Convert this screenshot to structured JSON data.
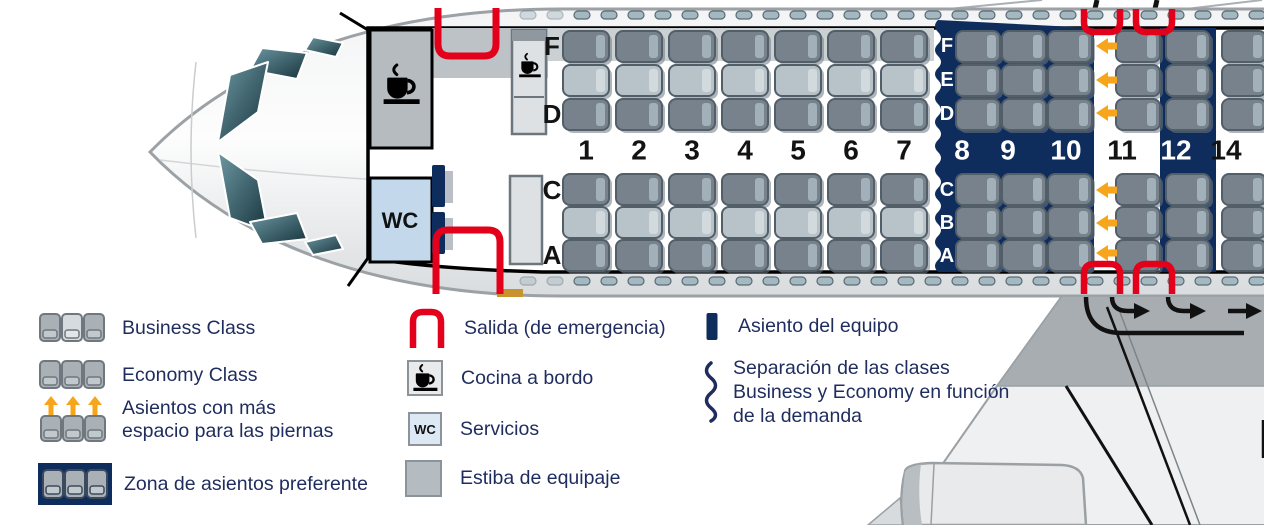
{
  "colors": {
    "navy": "#0e2c5c",
    "text_navy": "#1f2c5e",
    "red": "#e2001a",
    "orange": "#f7a51b",
    "door_sill": "#c8922f",
    "wc_blue": "#c3d9eb",
    "seat_dark": "#77828c",
    "seat_dark_border": "#525f69",
    "seat_light": "#b8c2c9",
    "seat_tab": "#a2b0b9",
    "seat_tab_light": "#d2dade",
    "seat_shadow": "#6e7a84",
    "galley_gray": "#b5bbbf",
    "band_gray": "#cbd0d3",
    "window_tick": "#a4b8c2"
  },
  "plan": {
    "wc_label": "WC",
    "front_letters_top": [
      "F",
      "D"
    ],
    "front_letters_bottom": [
      "C",
      "A"
    ],
    "zone_letters_top": [
      "F",
      "E",
      "D"
    ],
    "zone_letters_bottom": [
      "C",
      "B",
      "A"
    ],
    "rows": [
      {
        "number": "1",
        "seat_style": "business",
        "band": "white"
      },
      {
        "number": "2",
        "seat_style": "business",
        "band": "white"
      },
      {
        "number": "3",
        "seat_style": "business",
        "band": "white"
      },
      {
        "number": "4",
        "seat_style": "business",
        "band": "white"
      },
      {
        "number": "5",
        "seat_style": "business",
        "band": "white"
      },
      {
        "number": "6",
        "seat_style": "business",
        "band": "white"
      },
      {
        "number": "7",
        "seat_style": "business",
        "band": "white"
      },
      {
        "number": "8",
        "seat_style": "economy",
        "band": "navy"
      },
      {
        "number": "9",
        "seat_style": "economy",
        "band": "navy"
      },
      {
        "number": "10",
        "seat_style": "economy",
        "band": "navy"
      },
      {
        "number": "11",
        "seat_style": "economy",
        "band": "white",
        "extra_legroom": true
      },
      {
        "number": "12",
        "seat_style": "economy",
        "band": "navy"
      },
      {
        "number": "14",
        "seat_style": "economy",
        "band": "white"
      }
    ]
  },
  "legend": {
    "business": {
      "label": "Business Class"
    },
    "economy": {
      "label": "Economy Class"
    },
    "legroom": {
      "lines": [
        "Asientos con más",
        "espacio para las piernas"
      ]
    },
    "preferente": {
      "label": "Zona de asientos preferente"
    },
    "salida": {
      "label": "Salida (de emergencia)"
    },
    "cocina": {
      "label": "Cocina a bordo"
    },
    "servicios": {
      "label": "Servicios",
      "box_label": "WC"
    },
    "estiba": {
      "label": "Estiba de equipaje"
    },
    "equipo": {
      "label": "Asiento del equipo"
    },
    "separacion": {
      "lines": [
        "Separación de las clases",
        "Business y Economy en función",
        "de la demanda"
      ]
    }
  }
}
